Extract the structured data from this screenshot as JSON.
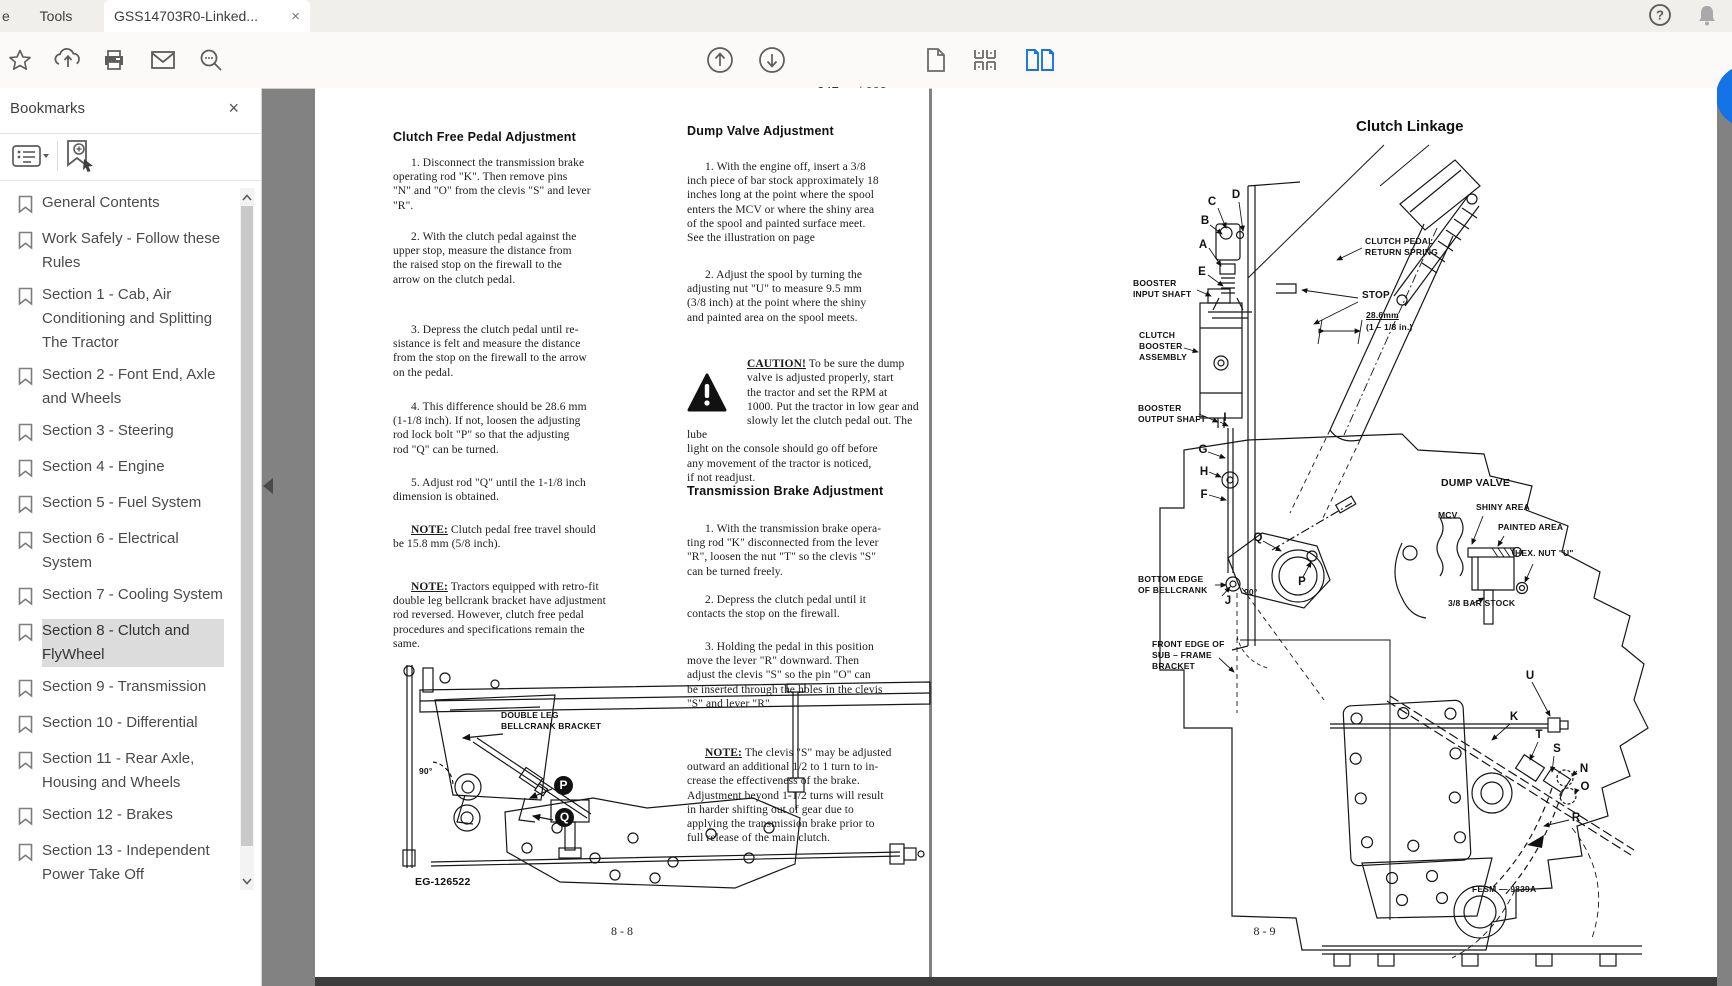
{
  "colors": {
    "accent_blue": "#1473e6",
    "doc_background": "#828282",
    "bookmark_highlight": "#dcdcdc"
  },
  "browser": {
    "edge_tab_fragment": "e",
    "tools_tab": "Tools",
    "document_tab": "GSS14703R0-Linked...",
    "close_tab": "×"
  },
  "toolbar": {
    "page_current": "247",
    "page_total": "/ 603"
  },
  "bookmarks": {
    "title": "Bookmarks",
    "close": "×",
    "items": [
      {
        "label": "General Contents"
      },
      {
        "label": "Work Safely - Follow these Rules"
      },
      {
        "label": "Section 1 - Cab, Air Conditioning and Splitting The Tractor"
      },
      {
        "label": "Section 2 - Font End, Axle and Wheels"
      },
      {
        "label": "Section 3 - Steering"
      },
      {
        "label": "Section 4 - Engine"
      },
      {
        "label": "Section 5 - Fuel System"
      },
      {
        "label": "Section 6 - Electrical System"
      },
      {
        "label": "Section 7 - Cooling System"
      },
      {
        "label": "Section 8 - Clutch and FlyWheel",
        "active": true
      },
      {
        "label": "Section 9 - Transmission"
      },
      {
        "label": "Section 10 - Differential"
      },
      {
        "label": "Section 11 - Rear Axle, Housing and Wheels"
      },
      {
        "label": "Section 12 - Brakes"
      },
      {
        "label": "Section 13 - Independent Power Take Off"
      },
      {
        "label": "Section 14 - Hydraulic"
      }
    ]
  },
  "page_left": {
    "col1": {
      "heading": "Clutch Free Pedal Adjustment",
      "p1": "1.  Disconnect the transmission brake\noperating rod \"K\".  Then remove pins\n\"N\" and \"O\" from the clevis \"S\" and lever\n\"R\".",
      "p2": "2.  With the clutch pedal against the\nupper stop, measure the distance from\nthe raised stop on the firewall to the\narrow on the clutch pedal.",
      "p3": "3.  Depress the clutch pedal until re-\nsistance is felt and measure the distance\nfrom the stop on the firewall to the arrow\non the pedal.",
      "p4": "4.  This difference should be 28.6 mm\n(1-1/8 inch).  If not, loosen the adjusting\nrod lock bolt \"P\" so that the adjusting\nrod \"Q\" can be turned.",
      "p5": "5.  Adjust rod \"Q\" until the 1-1/8 inch\ndimension is obtained.",
      "note_label": "NOTE:",
      "note1": " Clutch pedal free travel should\nbe 15.8 mm (5/8 inch).",
      "note2": " Tractors equipped with retro-fit\ndouble leg bellcrank bracket have adjustment\nrod reversed.  However, clutch free pedal\nprocedures and specifications remain the\nsame."
    },
    "col2": {
      "heading1": "Dump Valve Adjustment",
      "p1": "1.  With the engine off, insert a 3/8\ninch piece of bar stock approximately 18\ninches long at the point where the spool\nenters the MCV or where the shiny area\nof the spool and painted surface meet.\nSee the illustration on page",
      "p2": "2.  Adjust the spool by turning the\nadjusting nut \"U\" to measure 9.5 mm\n(3/8 inch) at the point where the shiny\nand painted area on the spool meets.",
      "caution_label": "CAUTION!",
      "caution": " To be sure the dump\nvalve is adjusted properly, start\nthe tractor and set the RPM at\n1000.  Put the tractor in low gear and\nslowly let the clutch pedal out.  The lube\nlight on the console should go off before\nany movement of the tractor is noticed,\nif not readjust.",
      "heading2": "Transmission Brake Adjustment",
      "p3": "1.  With the transmission brake opera-\nting rod \"K\" disconnected from the lever\n\"R\", loosen the nut \"T\" so the clevis \"S\"\ncan be turned freely.",
      "p4": "2.  Depress the clutch pedal until it\ncontacts the stop on the firewall.",
      "p5": "3.  Holding the pedal in this position\nmove the lever \"R\" downward.  Then\nadjust the clevis \"S\" so the pin \"O\" can\nbe inserted through the holes in the clevis\n\"S\" and lever \"R\".",
      "note_label": "NOTE:",
      "note3": " The clevis \"S\" may be adjusted\noutward an additional 1/2 to 1 turn to in-\ncrease the effectiveness of the brake.\nAdjustment beyond 1-1/2 turns will result\nin harder shifting out of gear due to\napplying the transmission brake prior to\nfull release of the main clutch."
    },
    "figure": {
      "bracket": "DOUBLE LEG\nBELLCRANK BRACKET",
      "p": "P",
      "q": "Q",
      "angle": "90°",
      "code": "EG-126522"
    },
    "footer": "8 - 8"
  },
  "page_right": {
    "title": "Clutch Linkage",
    "letters": {
      "a": "A",
      "b": "B",
      "c": "C",
      "d": "D",
      "e": "E",
      "f": "F",
      "g": "G",
      "h": "H",
      "i": "I",
      "j": "J",
      "k": "K",
      "n": "N",
      "o": "O",
      "p": "P",
      "q": "Q",
      "r": "R",
      "s": "S",
      "t": "T",
      "u": "U"
    },
    "labels": {
      "return_spring": "CLUTCH PEDAL\nRETURN SPRING",
      "stop": "STOP",
      "dim_mm": "28.6mm",
      "dim_in": "(1 – 1/8 in.)",
      "booster_input": "BOOSTER\nINPUT SHAFT",
      "clutch_booster": "CLUTCH\nBOOSTER\nASSEMBLY",
      "booster_output": "BOOSTER\nOUTPUT SHAFT",
      "dump_valve": "DUMP VALVE",
      "mcv": "MCV",
      "shiny": "SHINY AREA",
      "painted": "PAINTED AREA",
      "hex_nut": "HEX. NUT \"U\"",
      "bar_stock": "3/8 BAR STOCK",
      "bottom_edge": "BOTTOM EDGE\nOF BELLCRANK",
      "front_edge": "FRONT EDGE OF\nSUB – FRAME\nBRACKET",
      "angle": "90°",
      "code": "FESM — 9839A"
    },
    "footer": "8 - 9"
  }
}
